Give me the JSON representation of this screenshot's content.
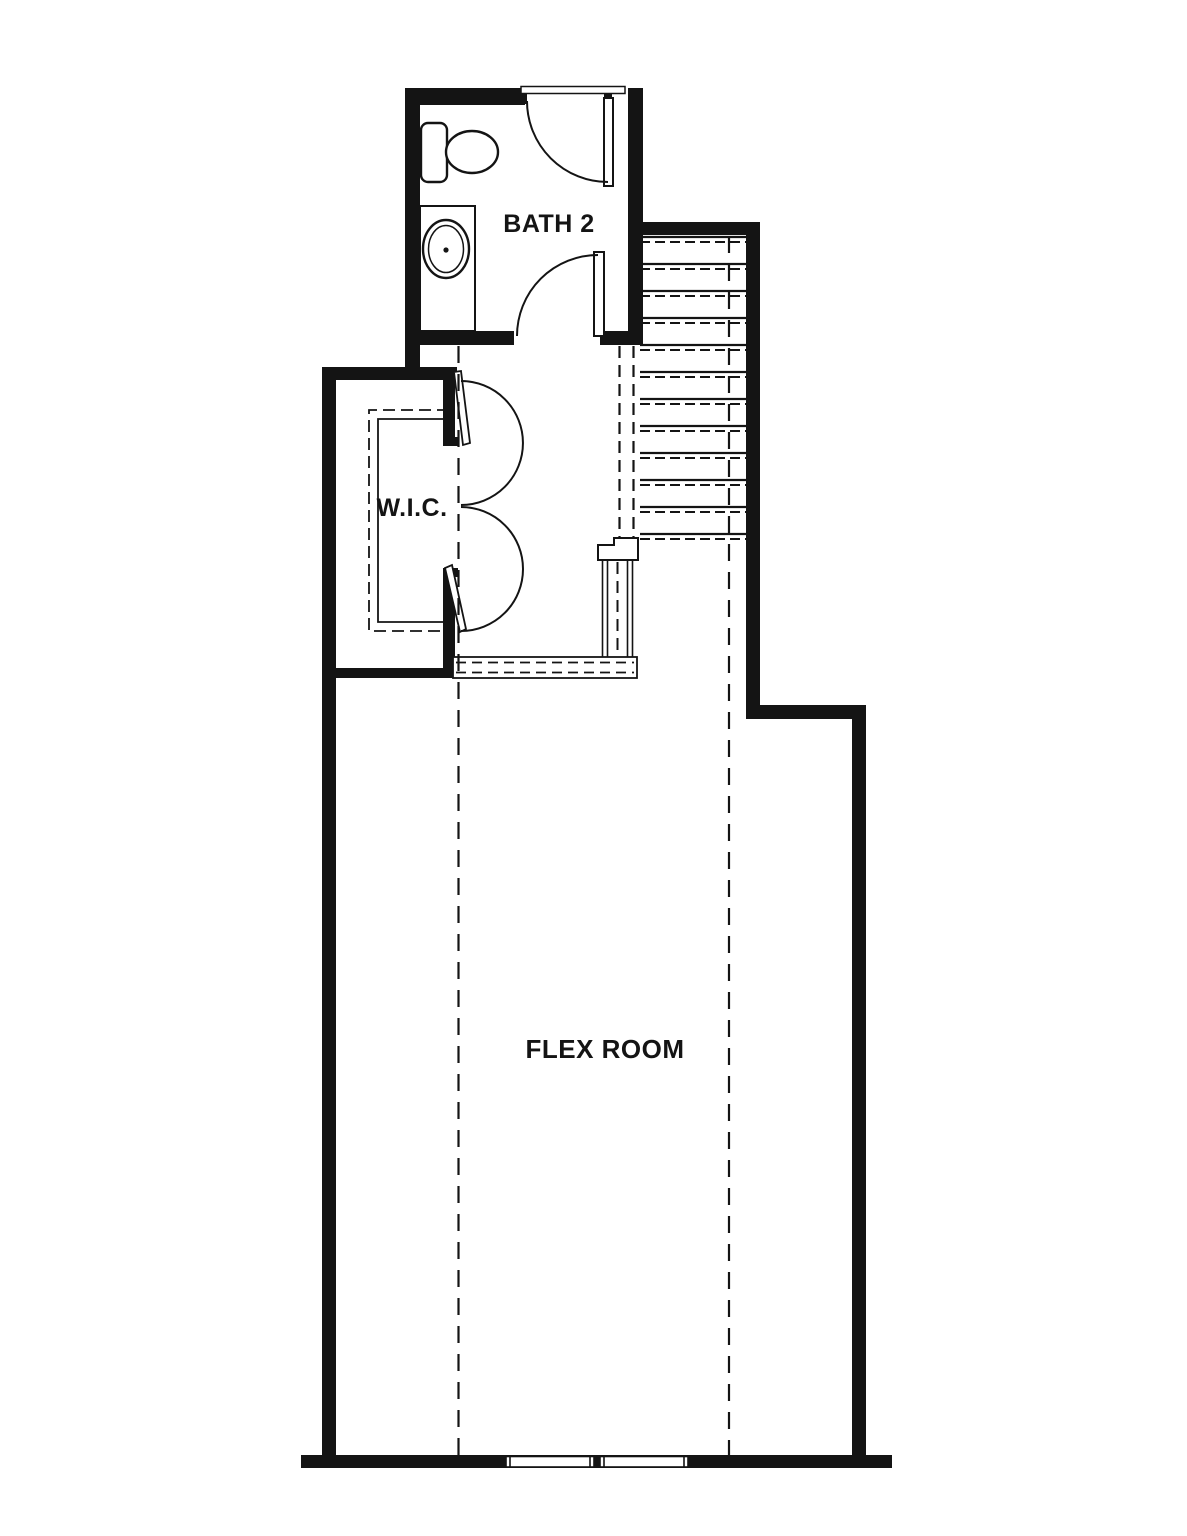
{
  "plan": {
    "colors": {
      "ink": "#141414",
      "background": "#ffffff"
    },
    "rooms": [
      {
        "id": "bath2",
        "label": "BATH 2"
      },
      {
        "id": "wic",
        "label": "W.I.C."
      },
      {
        "id": "flex",
        "label": "FLEX ROOM"
      }
    ],
    "fixtures": [
      "toilet",
      "vanity-sink",
      "staircase",
      "stair-railing",
      "closet-double-swing-doors",
      "swing-doors",
      "windows"
    ]
  }
}
